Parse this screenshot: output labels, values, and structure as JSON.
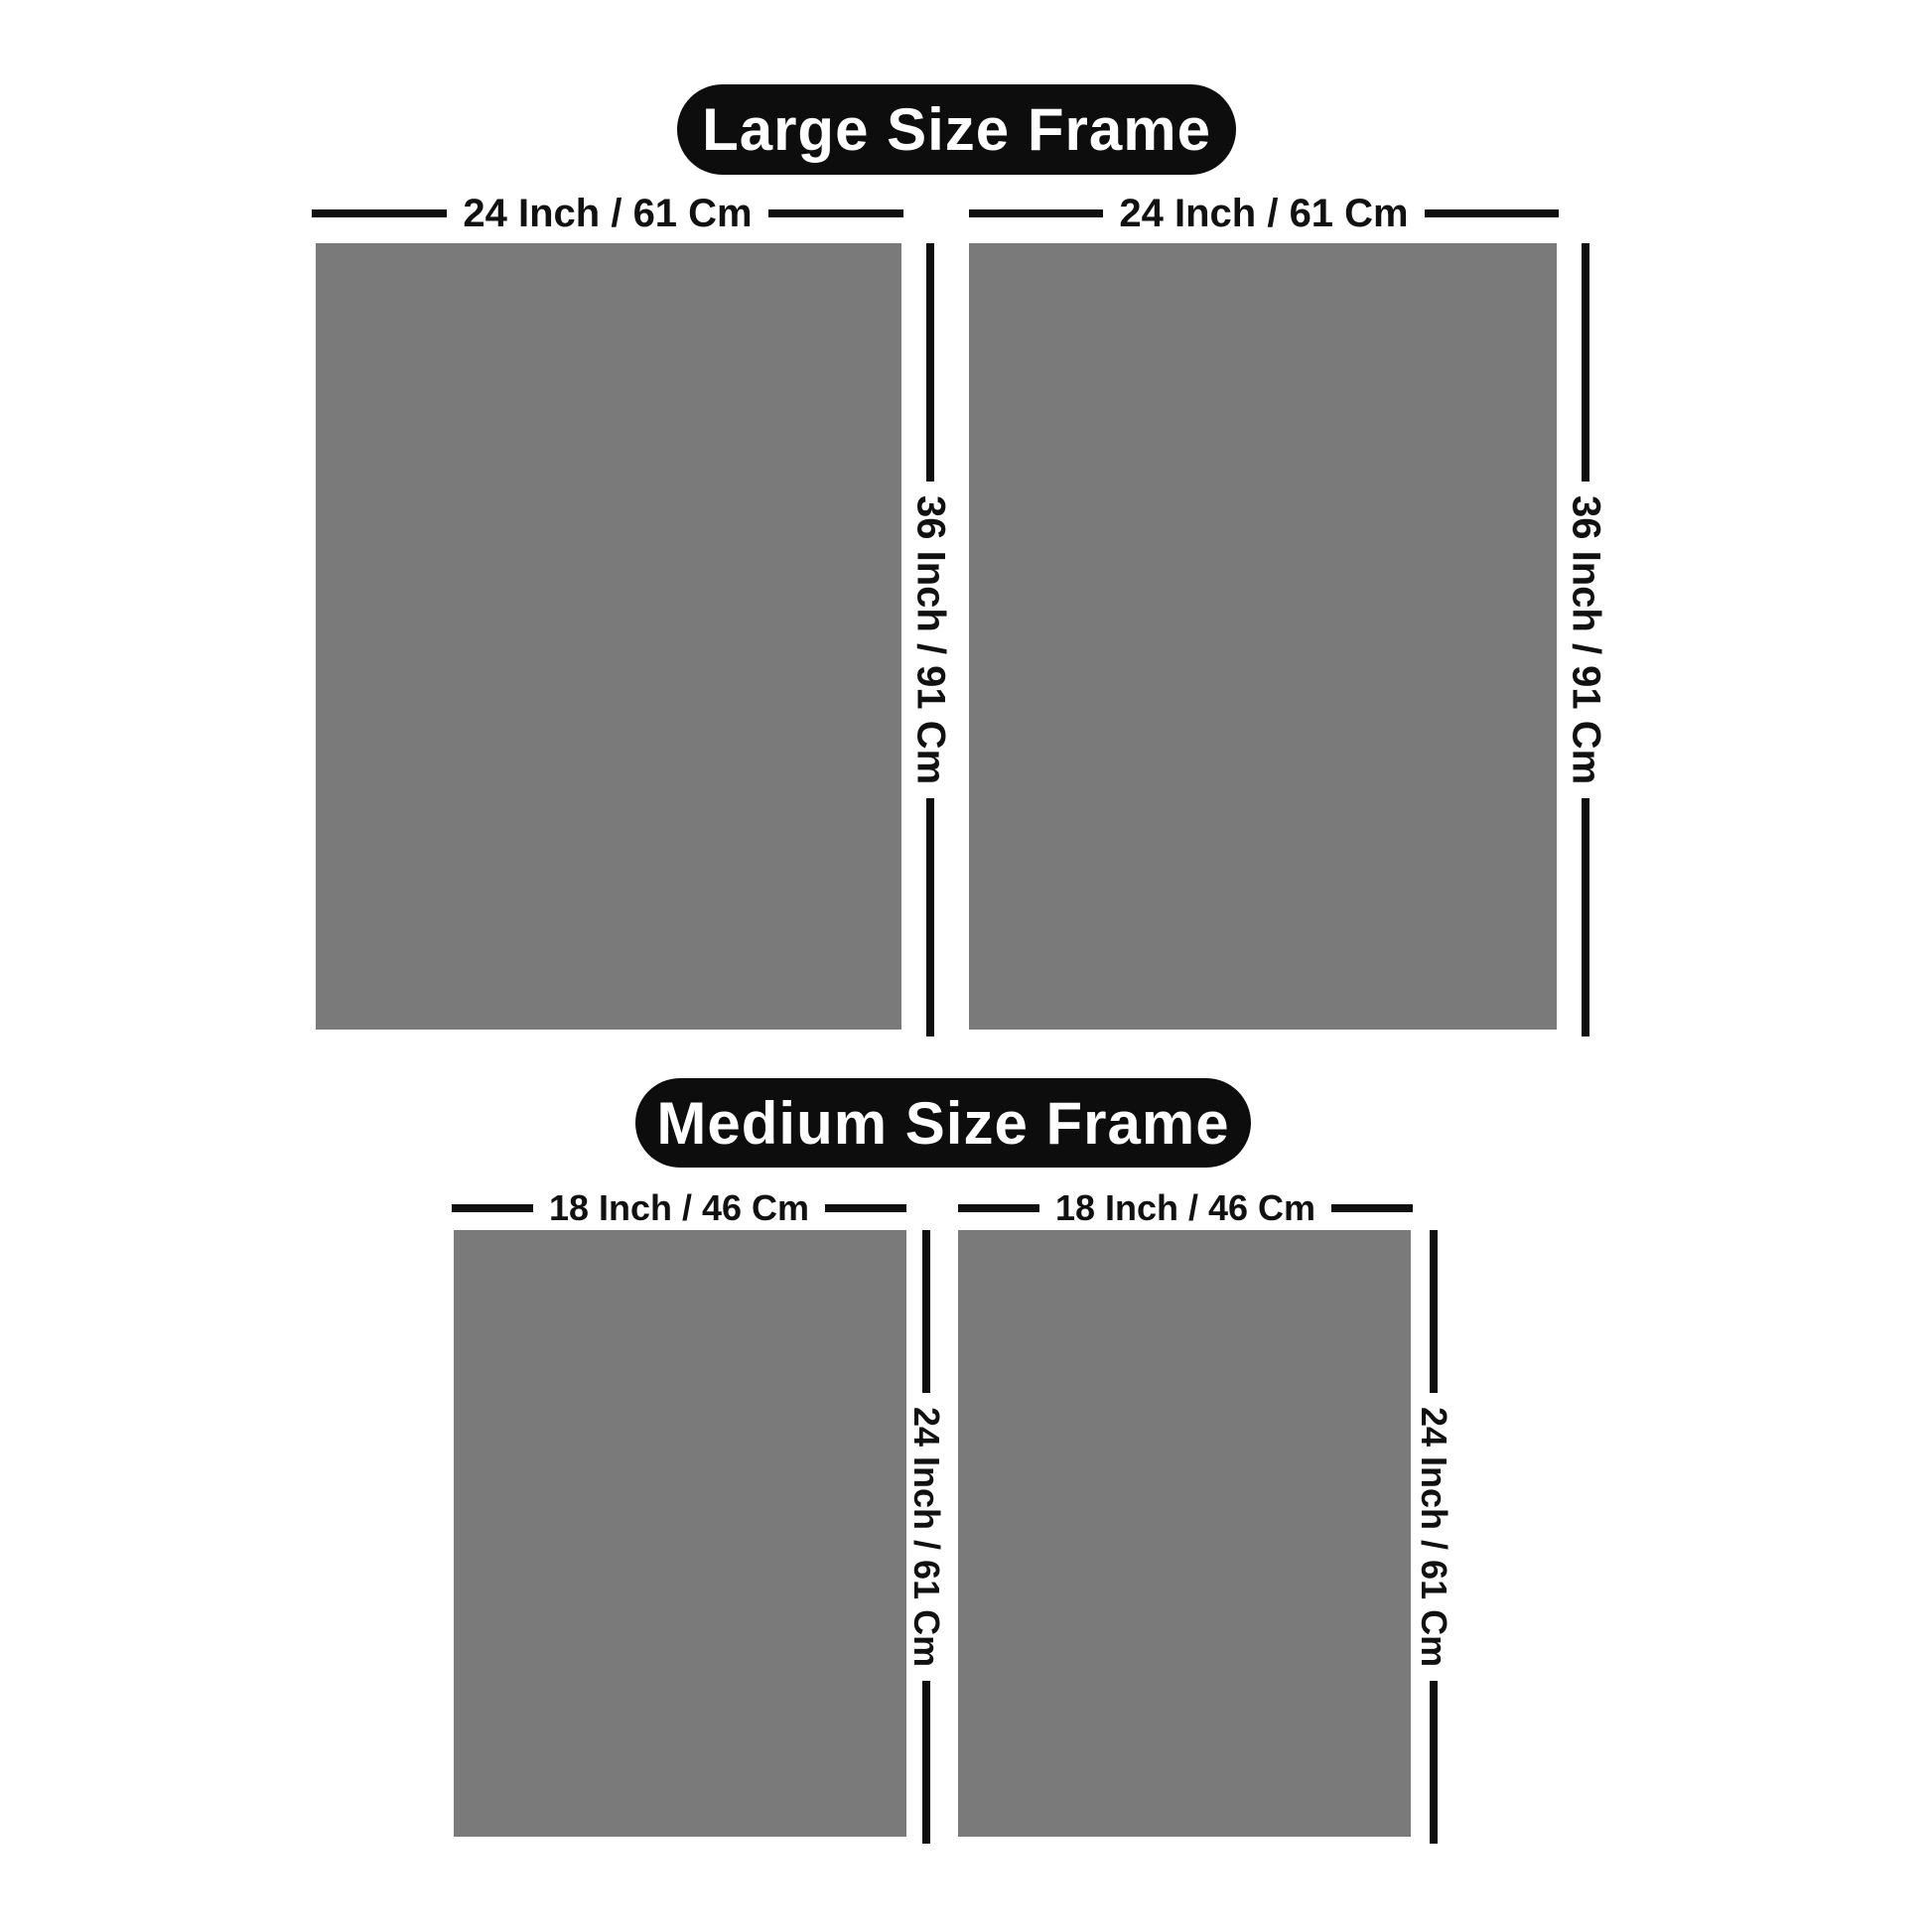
{
  "page": {
    "background": "#ffffff"
  },
  "colors": {
    "poster_gray": "#7a7a7a",
    "line_black": "#0f0f0f",
    "pill_background": "#0d0d0d",
    "pill_text": "#ffffff",
    "label_text": "#111111"
  },
  "sections": [
    {
      "id": "large",
      "title": "Large Size Frame",
      "frames": [
        {
          "width_label": "24 Inch / 61 Cm",
          "height_label": "36 Inch / 91 Cm"
        },
        {
          "width_label": "24 Inch / 61 Cm",
          "height_label": "36 Inch / 91 Cm"
        }
      ]
    },
    {
      "id": "medium",
      "title": "Medium Size Frame",
      "frames": [
        {
          "width_label": "18 Inch / 46 Cm",
          "height_label": "24 Inch / 61 Cm"
        },
        {
          "width_label": "18 Inch / 46 Cm",
          "height_label": "24 Inch / 61 Cm"
        }
      ]
    }
  ]
}
